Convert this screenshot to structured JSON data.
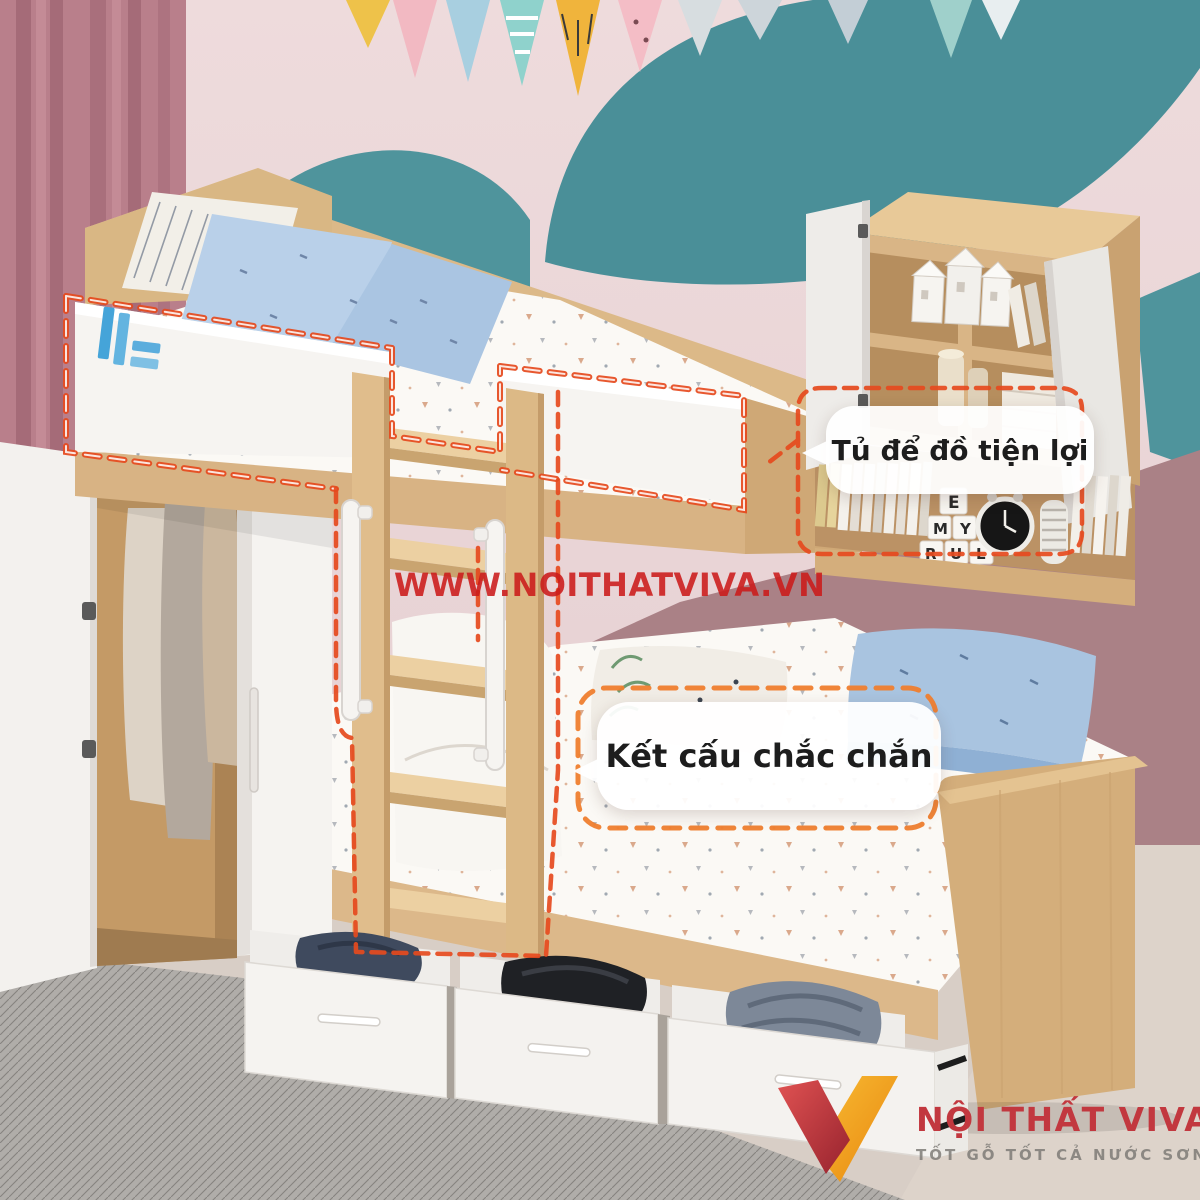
{
  "watermark": {
    "text": "WWW.NOITHATVIVA.VN"
  },
  "callouts": {
    "storage": {
      "label": "Tủ để đồ tiện lợi"
    },
    "structure": {
      "label": "Kết cấu chắc chắn"
    }
  },
  "brand": {
    "name": "NỘI THẤT VIVA",
    "tagline": "TỐT GỖ TỐT CẢ NƯỚC SƠN"
  },
  "decor": {
    "letter_blocks": [
      "E",
      "M",
      "Y",
      "R",
      "U",
      "L"
    ]
  },
  "colors": {
    "wall_pink": "#ead7d8",
    "wall_mauve": "#aa8186",
    "wall_teal": "#4f949c",
    "wood_light": "#e2c294",
    "wood_mid": "#d4ae7c",
    "wood_interior": "#c49a66",
    "white_furniture": "#f5f3f0",
    "annotation_red": "#e64a1e",
    "annotation_orange": "#ef7e2e",
    "watermark_red": "#cb1a1a",
    "logo_red": "#c2383f",
    "logo_yellow": "#f2a61f",
    "rail_logo_blue": "#45a4d9",
    "pillow_blue": "#b9d0e9"
  }
}
